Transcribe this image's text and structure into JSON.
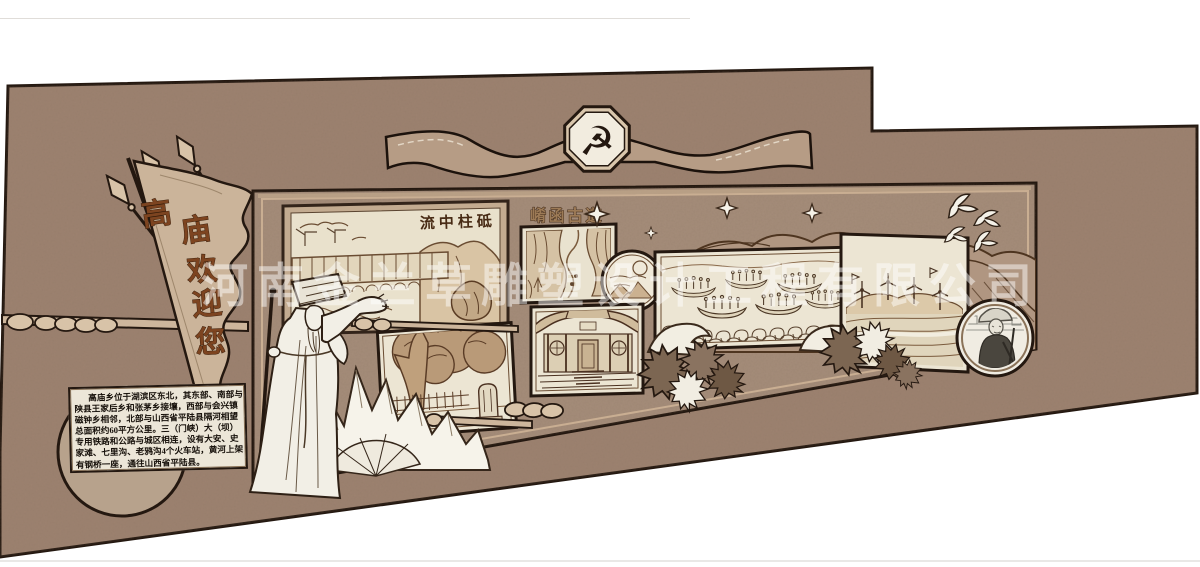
{
  "watermark": {
    "text": "河南金兰草雕塑设计工程有限公司",
    "color": "rgba(255,255,255,0.48)"
  },
  "flag": {
    "text": "高庙欢迎您",
    "chars": [
      "高",
      "庙",
      "欢",
      "迎",
      "您"
    ]
  },
  "banner": {
    "emblem_symbol": "☭"
  },
  "panels": {
    "dam": {
      "title": "流中柱砥"
    },
    "ancient_road": {
      "title": "崤函古道"
    }
  },
  "info_panel": {
    "lines": [
      "高庙乡位于湖滨区东北，其东部、南部与",
      "陕县王家后乡和张茅乡接壤，西部与会兴镇",
      "磁钟乡相邻，北部与山西省平陆县隔河相望",
      "总面积约60平方公里。三（门峡）大（坝）",
      "专用铁路和公路与城区相连，设有大安、史",
      "家滩、七里沟、老鸦沟4个火车站，黄河上架",
      "有钢桥一座，通往山西省平陆县。"
    ]
  },
  "colors": {
    "background": "#ffffff",
    "wall": "#9d8270",
    "display_wall": "#a58d7a",
    "panel_paper": "#e9e1cc",
    "panel_mat": "#c3ab90",
    "frame_dark": "#241810",
    "flag_fill": "#cbb49a",
    "ribbon_fill": "#b69c85",
    "etch_brown": "#6a4c32",
    "circle_tan": "#b7a28c"
  }
}
